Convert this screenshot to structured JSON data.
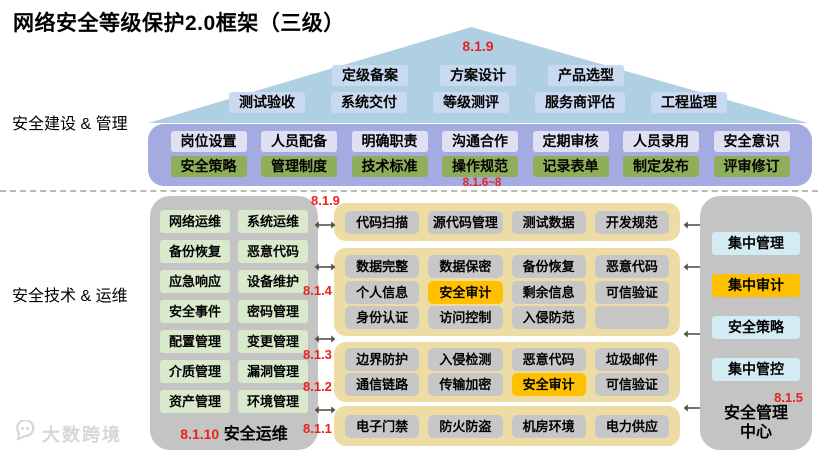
{
  "title": "网络安全等级保护2.0框架（三级）",
  "sections": {
    "build": "安全建设 & 管理",
    "tech": "安全技术 & 运维"
  },
  "roof": {
    "tag": "8.1.9",
    "row1": [
      "定级备案",
      "方案设计",
      "产品选型"
    ],
    "row2": [
      "测试验收",
      "系统交付",
      "等级测评",
      "服务商评估",
      "工程监理"
    ]
  },
  "management": {
    "row1": [
      "岗位设置",
      "人员配备",
      "明确职责",
      "沟通合作",
      "定期审核",
      "人员录用",
      "安全意识"
    ],
    "row2": [
      "安全策略",
      "管理制度",
      "技术标准",
      "操作规范",
      "记录表单",
      "制定发布",
      "评审修订"
    ],
    "tag": "8.1.6~8"
  },
  "operations": {
    "items": [
      "网络运维",
      "系统运维",
      "备份恢复",
      "恶意代码",
      "应急响应",
      "设备维护",
      "安全事件",
      "密码管理",
      "配置管理",
      "变更管理",
      "介质管理",
      "漏洞管理",
      "资产管理",
      "环境管理"
    ],
    "tag": "8.1.10",
    "footer": "安全运维"
  },
  "middle": {
    "blocks": [
      {
        "tag": "8.1.9",
        "rows": [
          [
            "代码扫描",
            "源代码管理",
            "测试数据",
            "开发规范"
          ]
        ]
      },
      {
        "tag": "8.1.4",
        "rows": [
          [
            "数据完整",
            "数据保密",
            "备份恢复",
            "恶意代码"
          ],
          [
            "个人信息",
            {
              "label": "安全审计",
              "highlight": true
            },
            "剩余信息",
            "可信验证"
          ],
          [
            "身份认证",
            "访问控制",
            "入侵防范",
            {
              "label": ""
            }
          ]
        ]
      },
      {
        "tag": "8.1.3",
        "tag2": "8.1.2",
        "rows": [
          [
            "边界防护",
            "入侵检测",
            "恶意代码",
            "垃圾邮件"
          ],
          [
            "通信链路",
            "传输加密",
            {
              "label": "安全审计",
              "highlight": true
            },
            "可信验证"
          ]
        ]
      },
      {
        "tag": "8.1.1",
        "rows": [
          [
            "电子门禁",
            "防火防盗",
            "机房环境",
            "电力供应"
          ]
        ]
      }
    ]
  },
  "center": {
    "items": [
      "集中管理",
      {
        "label": "集中审计",
        "highlight": true
      },
      "安全策略",
      "集中管控"
    ],
    "tag": "8.1.5",
    "footer": "安全管理中心"
  },
  "watermark": "大数跨境",
  "colors": {
    "tag_red": "#e8231d",
    "highlight_gold": "#ffc000",
    "roof_blue": "#afd0e2",
    "roof_pill_blue": "#c9d9f0",
    "band_purple": "#a3abe0",
    "lavender_pill": "#e1e0f3",
    "green_pill": "#8fae5a",
    "light_green_pill": "#d9e9cc",
    "tan_block": "#eddda4",
    "gray_box": "#c4c4c4",
    "gray_pill": "#c7c7c7",
    "cyan_pill": "#d3ebf3"
  }
}
